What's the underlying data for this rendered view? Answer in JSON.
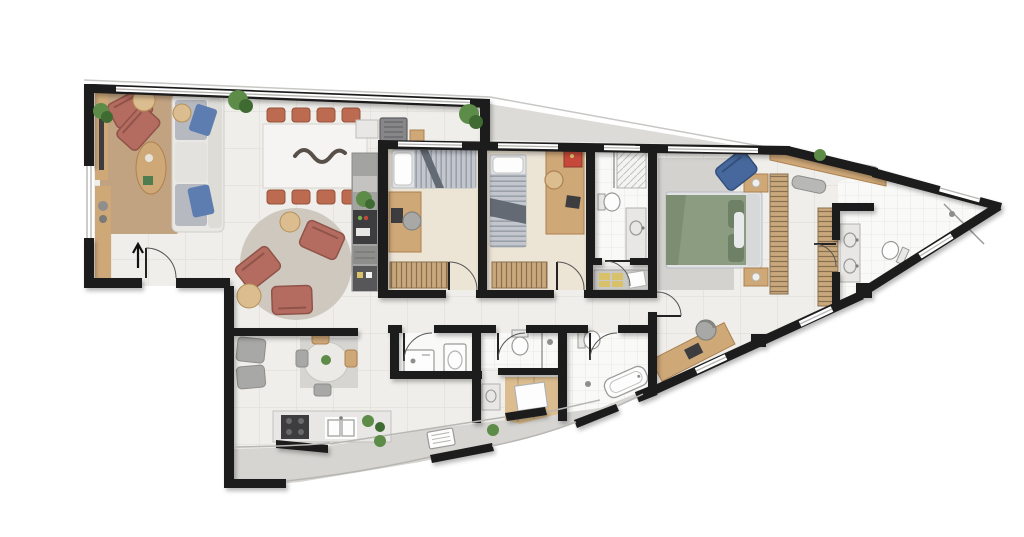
{
  "document": {
    "kind": "residential apartment floor plan",
    "visible_text": [],
    "labels_visible": false
  },
  "palette": {
    "wall": "#1b1b1b",
    "floor": "#efeeea",
    "bedroom_floor": "#ece4d4",
    "bath_floor": "#f9f9f8",
    "niche_floor": "#e3e2df",
    "terrace_floor": "#d6d5d2",
    "wedge": "#dcdbd8",
    "glass": "#b9b7b3",
    "wood": "#cfa878",
    "wood_light": "#dcbd8f",
    "wood_dark": "#b98f5e",
    "rug_living": "#c2a381",
    "rug_round": "#cfc8bf",
    "rug_master": "#d3d2cf",
    "rug_family": "#d6d5d2",
    "sofa": "#e9e8e4",
    "cushion": "#b6bac0",
    "pillow_blue": "#5d7db0",
    "chair_rose": "#b56c60",
    "chair_terracotta": "#bc6a50",
    "chair_gray": "#a8a8a6",
    "table_white": "#f5f4f2",
    "counter": "#e8e7e5",
    "appliance_dark": "#3d3d3f",
    "appliance_gray": "#8e8e8c",
    "cabinet_gray": "#a3a3a1",
    "bed_light": "#e0e2e5",
    "bed_stripe": "#a8adb5",
    "bed_fold": "#646a74",
    "bed_green": "#8c9c80",
    "pillow_green": "#6e8066",
    "plant": "#5c8c48",
    "plant_dark": "#3f6b33",
    "fixture": "#fdfdfd",
    "fixture_stroke": "#9a9a98",
    "blue_chair": "#47689c",
    "art_red": "#c6483a",
    "towel_yellow": "#d9c169",
    "sculpture": "#57504a",
    "bench_gray": "#b8b8b6"
  },
  "plan": {
    "canvas": {
      "width": 1024,
      "height": 537
    },
    "shape": "tapered-sail-outline",
    "rooms": [
      {
        "id": "living-room",
        "furniture": [
          "sofa",
          "lounge-chair",
          "lounge-chair",
          "oval-coffee-table",
          "area-rug",
          "tv-sideboard",
          "side-table",
          "plants"
        ]
      },
      {
        "id": "dining-area",
        "furniture": [
          "dining-table",
          "eight-chairs",
          "table-sculpture"
        ]
      },
      {
        "id": "gourmet-balcony",
        "furniture": [
          "bbq-grill",
          "prep-counter",
          "cutting-board",
          "plant"
        ]
      },
      {
        "id": "sitting-circle",
        "furniture": [
          "round-rug",
          "lounge-chair",
          "lounge-chair",
          "lounge-chair",
          "side-table",
          "side-table"
        ]
      },
      {
        "id": "family-nook",
        "furniture": [
          "armchair",
          "armchair",
          "round-table",
          "dining-chairs",
          "rug"
        ]
      },
      {
        "id": "kitchen",
        "furniture": [
          "tall-cabinet-column",
          "island-counter",
          "cooktop",
          "double-sink",
          "plants"
        ]
      },
      {
        "id": "laundry",
        "furniture": [
          "washing-machine",
          "utility-sink"
        ]
      },
      {
        "id": "bedroom-1",
        "furniture": [
          "single-bed",
          "desk",
          "desk-chair",
          "laptop",
          "wardrobe"
        ]
      },
      {
        "id": "bedroom-2",
        "furniture": [
          "single-bed",
          "desk",
          "desk-chair",
          "laptop",
          "wall-art",
          "wardrobe"
        ]
      },
      {
        "id": "bathroom-1",
        "furniture": [
          "shower",
          "toilet",
          "vanity",
          "towel-cabinet"
        ]
      },
      {
        "id": "corridor",
        "furniture": []
      },
      {
        "id": "master-bedroom",
        "furniture": [
          "double-bed",
          "nightstand",
          "nightstand",
          "rug",
          "blue-lounge-chair",
          "wardrobe",
          "wardrobe",
          "sloped-closet",
          "bench",
          "desk",
          "desk-chair"
        ]
      },
      {
        "id": "master-bathroom",
        "furniture": [
          "double-vanity",
          "toilet",
          "corner-shower"
        ]
      },
      {
        "id": "bathroom-2",
        "furniture": [
          "toilet",
          "shower",
          "vanity",
          "wood-closet"
        ]
      },
      {
        "id": "bathroom-3",
        "furniture": [
          "toilet",
          "bathtub"
        ]
      },
      {
        "id": "service-terrace",
        "furniture": [
          "ac-condenser",
          "plant",
          "plant"
        ]
      }
    ],
    "entry": "arrow-marker-at-lower-left-door"
  }
}
